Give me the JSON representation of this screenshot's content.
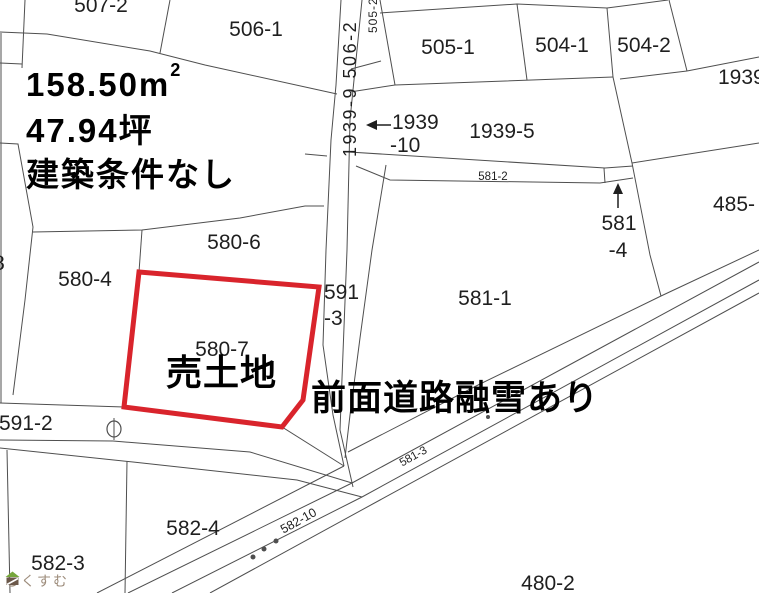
{
  "colors": {
    "highlight": "#d9242c",
    "line": "#4f4f4f",
    "label": "#1f1f1f",
    "annotation": "#000000",
    "watermark_text": "#9d8c7b",
    "logo_green": "#76a63c",
    "logo_brown": "#6b584a"
  },
  "annotations": {
    "area_m2_main": "158.50m",
    "area_m2_sup": "2",
    "area_tsubo": "47.94坪",
    "building_condition": "建築条件なし",
    "sale_label": "売土地",
    "road_note": "前面道路融雪あり"
  },
  "labels": {
    "p507_2": "507-2",
    "p506_1": "506-1",
    "p505_1": "505-1",
    "p504_1": "504-1",
    "p504_2": "504-2",
    "p1939_right": "1939",
    "p1939_10_line1": "1939",
    "p1939_10_line2": "-10",
    "p1939_5": "1939-5",
    "p581_2": "581-2",
    "p485": "485-",
    "p581_4_line1": "581",
    "p581_4_line2": "-4",
    "p591_3_line1": "591",
    "p591_3_line2": "-3",
    "p581_1": "581-1",
    "p580_6": "580-6",
    "p580_4": "580-4",
    "p580_7": "580-7",
    "p591_2": "591-2",
    "p582_4": "582-4",
    "p582_3": "582-3",
    "p480_2": "480-2",
    "p582_10": "582-10",
    "p581_3": "581-3",
    "p_left_clip": "8",
    "road_strip_vertical": "1939-9 506-2",
    "p505_2": "505-2"
  },
  "watermark": {
    "text": "らくすむ",
    "logo": "house-flag-icon"
  }
}
